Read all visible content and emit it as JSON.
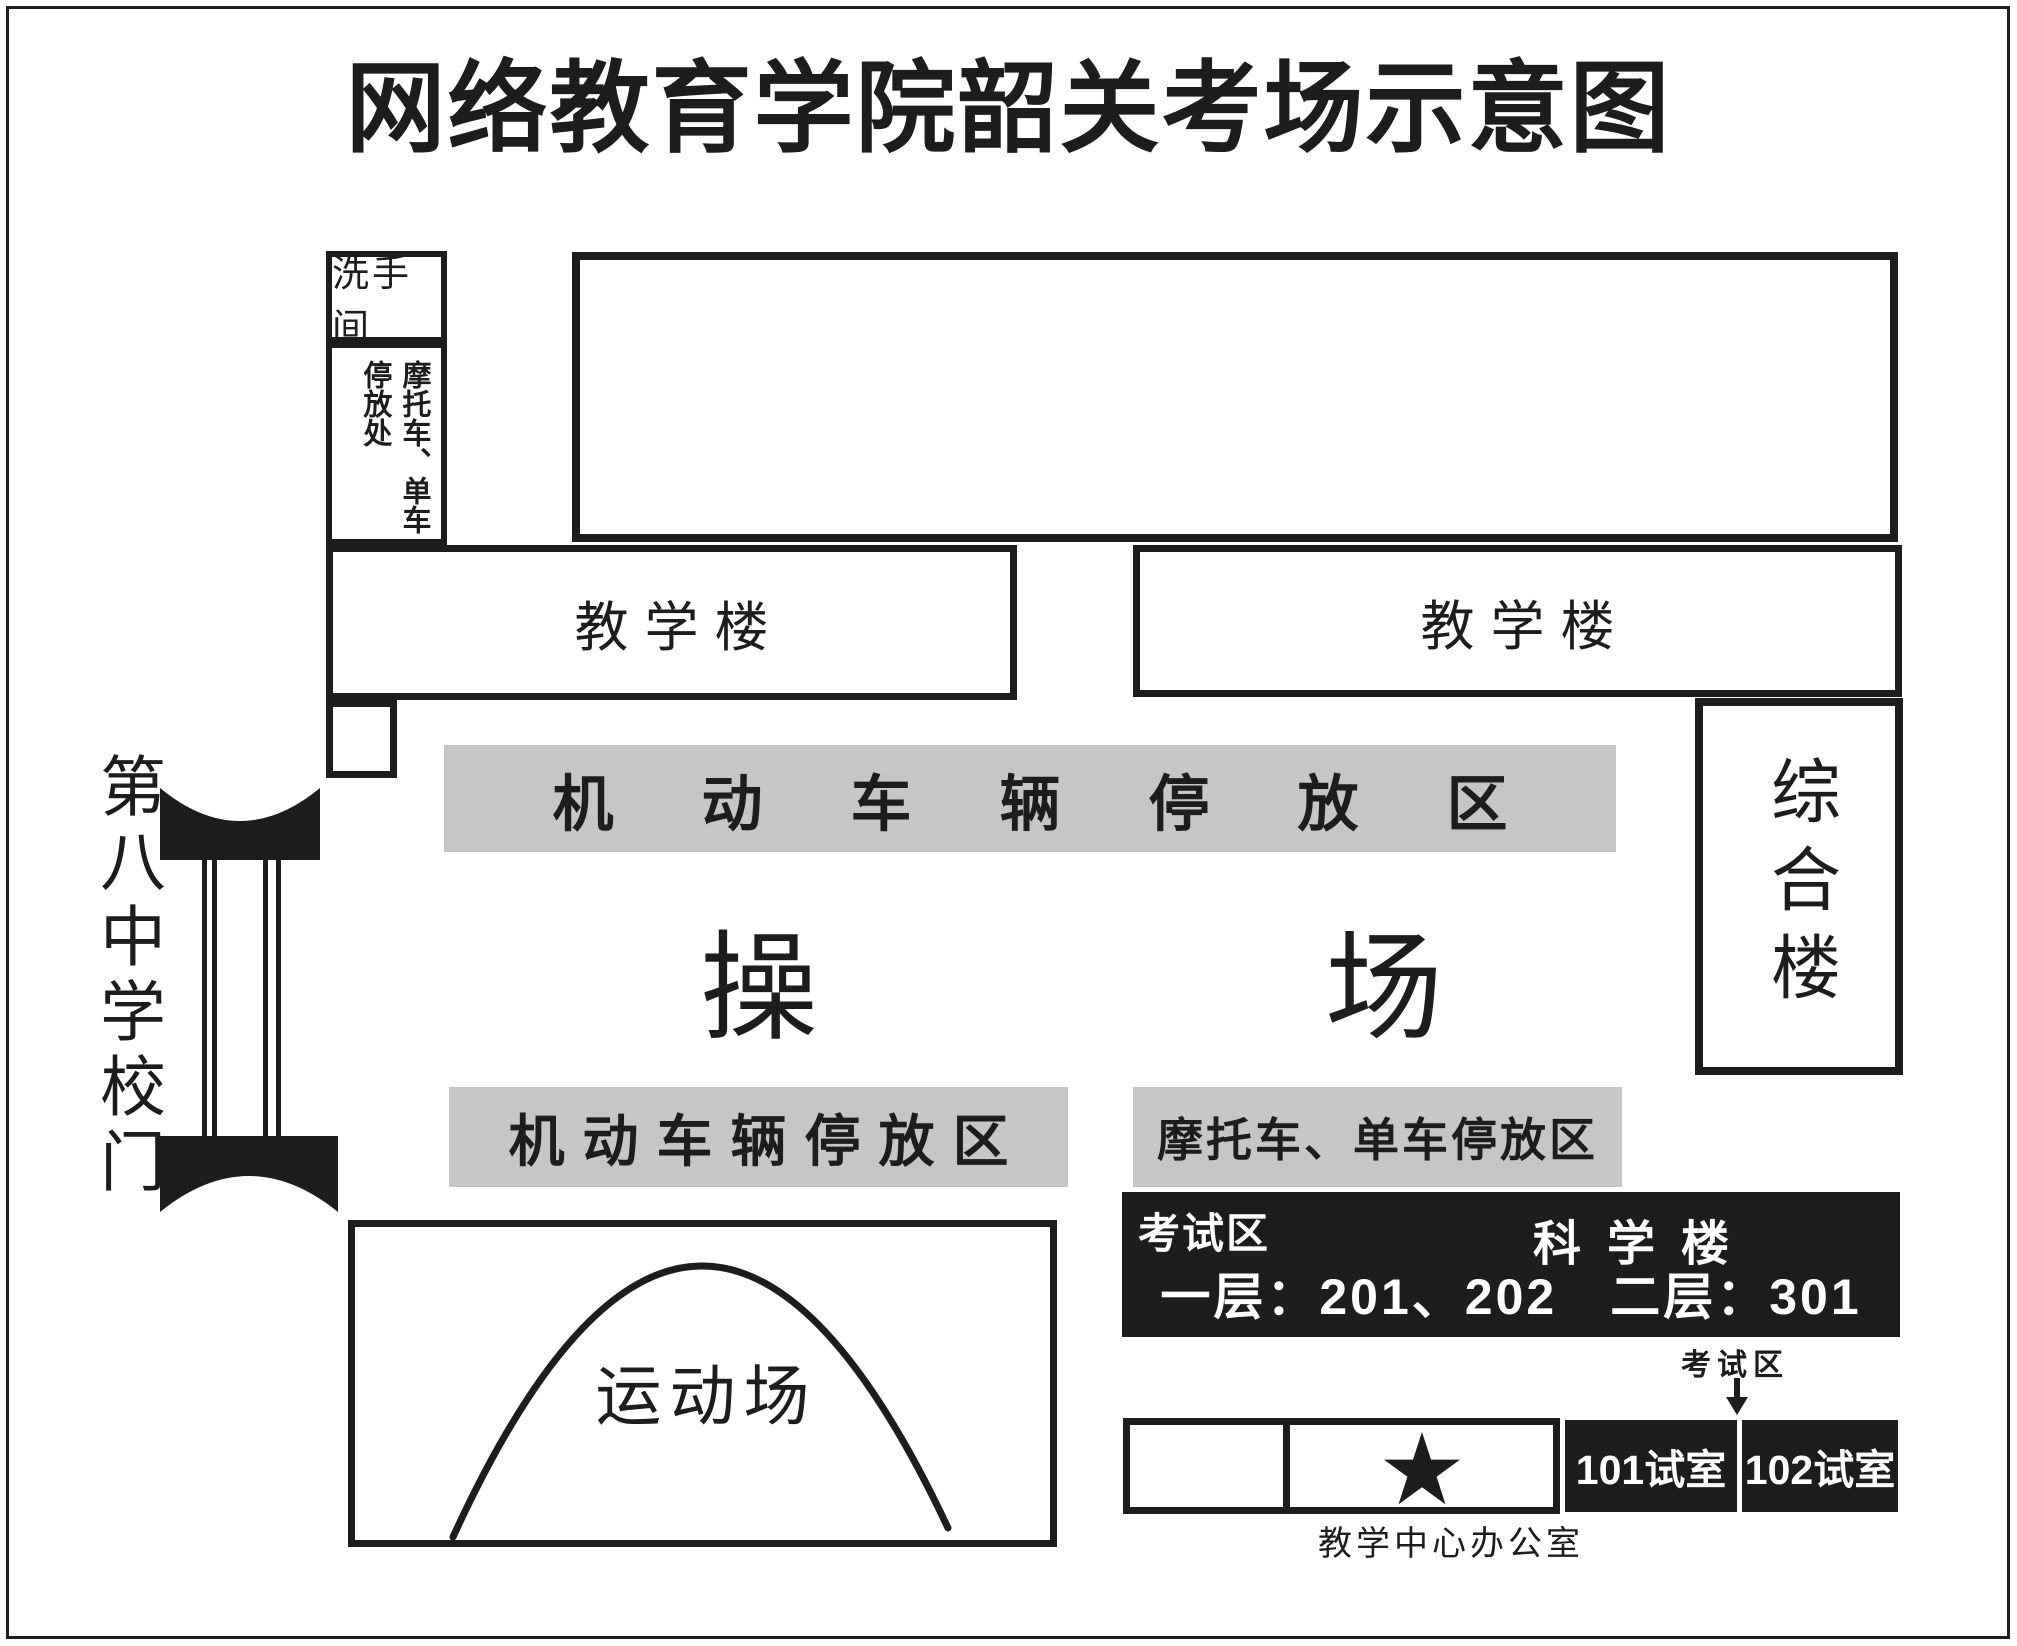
{
  "title": "网络教育学院韶关考场示意图",
  "colors": {
    "ink": "#1d1d1d",
    "gray": "#c6c6c6",
    "paper": "#ffffff"
  },
  "left_column": {
    "restroom": "洗手间",
    "moto_bike_parking": "摩托车、单车\n停放处"
  },
  "buildings": {
    "teaching_left": "教学楼",
    "teaching_right": "教学楼",
    "complex": "综合楼"
  },
  "playground": {
    "char_left": "操",
    "char_right": "场"
  },
  "parking_zones": {
    "motor_top": "机动车辆停放区",
    "motor_bottom": "机动车辆停放区",
    "moto_bike": "摩托车、单车停放区"
  },
  "exam_area": {
    "zone_badge": "考试区",
    "building": "科学楼",
    "rooms": "一层：201、202　二层：301",
    "pointer": "考试区",
    "room_101": "101试室",
    "room_102": "102试室",
    "office_caption": "教学中心办公室"
  },
  "gate": {
    "label": "第八中学校门"
  },
  "sports_field": {
    "label": "运动场"
  }
}
